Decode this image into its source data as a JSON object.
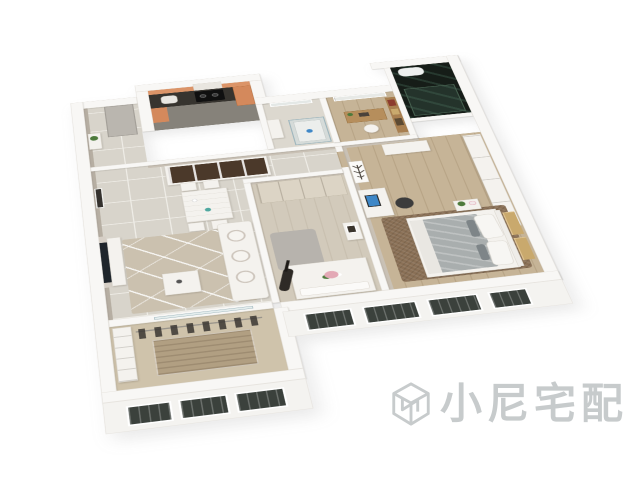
{
  "meta": {
    "description": "3D rendered bird's-eye floor plan of a furnished apartment on a white background",
    "background": "#ffffff"
  },
  "watermark": {
    "text": "小尼宅配",
    "icon": "cube-logo-icon",
    "color": "#9aa0a3",
    "opacity": 0.55
  },
  "scene": {
    "rooms": [
      "entry-hall",
      "kitchen",
      "bathroom",
      "study",
      "dark-glass-bathroom",
      "dining-area",
      "living-room",
      "second-bedroom",
      "master-bedroom",
      "balcony"
    ],
    "key_objects": [
      "range-hood",
      "cooktop",
      "sink",
      "china-cabinet",
      "dining-table",
      "dining-chairs",
      "wall-picture",
      "tv",
      "tv-console",
      "area-rug",
      "coffee-table",
      "sofa",
      "round-pillows",
      "glass-shower",
      "window",
      "desk",
      "office-chair",
      "bookshelf",
      "toilet",
      "built-in-wardrobe",
      "double-bed",
      "guitar",
      "flower-bouquet",
      "antler-art",
      "computer-monitor",
      "wardrobe-row",
      "shag-rug",
      "master-bed",
      "nightstand",
      "headboard-art-panels",
      "drying-clothes",
      "facade-windows"
    ]
  },
  "colors": {
    "wall": "#f8f7f5",
    "wall_edge": "#e7e4df",
    "wall_face": "#b6aea2",
    "wall_face_light": "#c9c1b5",
    "tile": "#d8d4cb",
    "tile_line": "#efede7",
    "kitchen_floor": "#86827a",
    "counter": "#37342f",
    "cabinet_orange": "#d4895c",
    "backsplash": "#db9468",
    "hood": "#e9e6e0",
    "bath_tile": "#dcd8cf",
    "glass_edge": "#9fb6bd",
    "glass_fill": "rgba(205,224,228,0.45)",
    "wood": "#c6b497",
    "study_desk": "#b68e5c",
    "shelf_wood": "#a87f50",
    "book_red": "#8c3b2e",
    "darkbath": "#161d18",
    "darkglass": "rgba(80,120,100,0.25)",
    "darkglass_edge": "#46604f",
    "china_interior": "#4b392a",
    "furniture_white": "#f4f2ee",
    "furniture_edge": "#dedad2",
    "rug_living": "#cbc1af",
    "rug_master": "#8a7056",
    "rug_gray": "#b7b3ad",
    "tv_dark": "#1f252b",
    "monitor_blue": "#3e87c7",
    "chair_dark": "#3c3c3c",
    "bed2_floor": "#d2cabb",
    "wardrobe_cream": "#dcd4c5",
    "blanket_gray": "#a9aeae",
    "sheet": "#e9e7e2",
    "pillow_pattern": "#7e8588",
    "art_tan": "#c9a96d",
    "art_tan_light": "#e0c491",
    "antler_dark": "#4a443c",
    "plant_green": "#4d7a3c",
    "flower_pink": "#e3a8b5",
    "balcony_floor": "#cfc3ab",
    "balcony_inlay": "#b19f82",
    "clothes_dark": "#3a3632",
    "facade": "#f4f3f0",
    "window_dark": "#3b413c",
    "door_gray": "#bab6af",
    "shadow": "rgba(110,110,110,0.14)",
    "wm_color": "#9aa0a3"
  }
}
